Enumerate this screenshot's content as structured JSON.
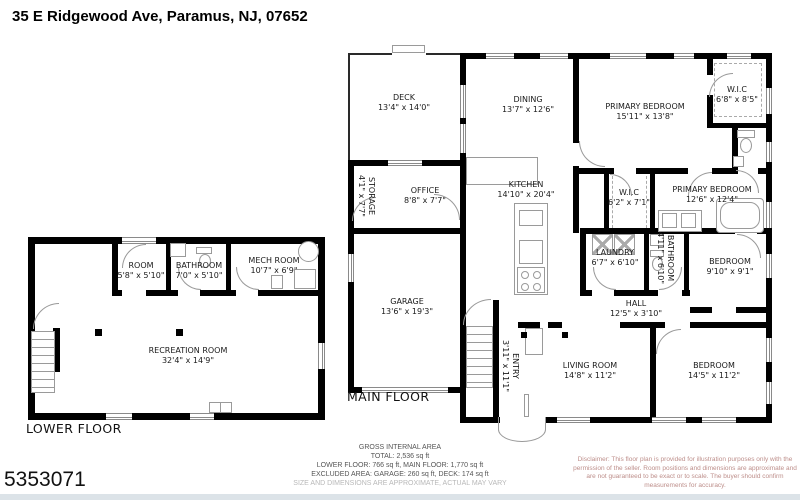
{
  "title": "35 E Ridgewood Ave, Paramus, NJ, 07652",
  "listing_id": "5353071",
  "floors": {
    "main": {
      "label": "MAIN FLOOR"
    },
    "lower": {
      "label": "LOWER FLOOR"
    }
  },
  "rooms": {
    "deck": {
      "name": "DECK",
      "dims": "13'4\" x 14'0\""
    },
    "dining": {
      "name": "DINING",
      "dims": "13'7\" x 12'6\""
    },
    "primary_bedroom_1": {
      "name": "PRIMARY BEDROOM",
      "dims": "15'11\" x 13'8\""
    },
    "wic_1": {
      "name": "W.I.C",
      "dims": "6'8\" x 8'5\""
    },
    "storage": {
      "name": "STORAGE",
      "dims": "4'1\" x 7'7\""
    },
    "office": {
      "name": "OFFICE",
      "dims": "8'8\" x 7'7\""
    },
    "kitchen": {
      "name": "KITCHEN",
      "dims": "14'10\" x 20'4\""
    },
    "wic_2": {
      "name": "W.I.C",
      "dims": "6'2\" x 7'1\""
    },
    "primary_bedroom_2": {
      "name": "PRIMARY BEDROOM",
      "dims": "12'6\" x 12'4\""
    },
    "laundry": {
      "name": "LAUNDRY",
      "dims": "6'7\" x 6'10\""
    },
    "bathroom_main": {
      "name": "BATHROOM",
      "dims": "4'11\" x 6'10\""
    },
    "bedroom_small": {
      "name": "BEDROOM",
      "dims": "9'10\" x 9'1\""
    },
    "hall": {
      "name": "HALL",
      "dims": "12'5\" x 3'10\""
    },
    "garage": {
      "name": "GARAGE",
      "dims": "13'6\" x 19'3\""
    },
    "entry": {
      "name": "ENTRY",
      "dims": "3'11\" x 11'1\""
    },
    "living_room": {
      "name": "LIVING ROOM",
      "dims": "14'8\" x 11'2\""
    },
    "bedroom_large": {
      "name": "BEDROOM",
      "dims": "14'5\" x 11'2\""
    },
    "room_lower": {
      "name": "ROOM",
      "dims": "5'8\" x 5'10\""
    },
    "bathroom_lower": {
      "name": "BATHROOM",
      "dims": "7'0\" x 5'10\""
    },
    "mech_room": {
      "name": "MECH ROOM",
      "dims": "10'7\" x 6'9\""
    },
    "recreation_room": {
      "name": "RECREATION ROOM",
      "dims": "32'4\" x 14'9\""
    }
  },
  "area_summary": {
    "heading": "GROSS INTERNAL AREA",
    "total": "TOTAL: 2,536 sq ft",
    "floors": "LOWER FLOOR: 766 sq ft, MAIN FLOOR: 1,770 sq ft",
    "excluded": "EXCLUDED AREA: GARAGE: 260 sq ft, DECK: 174 sq ft",
    "note": "SIZE AND DIMENSIONS ARE APPROXIMATE, ACTUAL MAY VARY"
  },
  "disclaimer": "Disclaimer: This floor plan is provided for illustration purposes only with the permission of the seller. Room positions and dimensions are approximate and are not guaranteed to be exact or to scale. The buyer should confirm measurements for accuracy.",
  "colors": {
    "wall": "#000000",
    "fixture_line": "#9a9a9a",
    "disclaimer_text": "#bd8e8a",
    "note_text": "#b8b8b8",
    "footer_strip": "#dce3e8"
  }
}
